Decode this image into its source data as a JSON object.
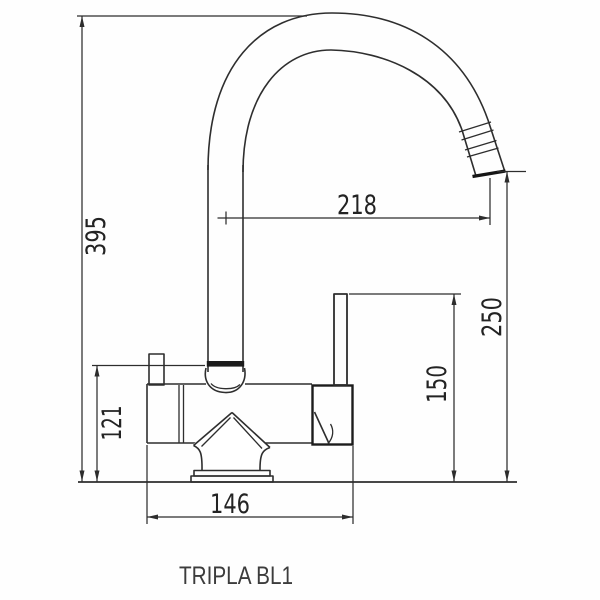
{
  "product": {
    "name": "TRIPLA BL1"
  },
  "dims": {
    "total_height": "395",
    "spout_reach": "218",
    "spout_outlet_height": "250",
    "handle_height": "150",
    "body_height": "121",
    "base_width": "146"
  },
  "drawing": {
    "type": "technical-dimension-drawing",
    "line_color": "#2e2e2e",
    "background": "#fefefe",
    "dimensions": [
      {
        "label": "395",
        "orientation": "vertical",
        "measures": "overall height to top of spout arc"
      },
      {
        "label": "218",
        "orientation": "horizontal",
        "measures": "spout reach from column axis to outlet"
      },
      {
        "label": "250",
        "orientation": "vertical",
        "measures": "outlet height above base"
      },
      {
        "label": "150",
        "orientation": "vertical",
        "measures": "handle lever height above base"
      },
      {
        "label": "121",
        "orientation": "vertical",
        "measures": "body joint height above base"
      },
      {
        "label": "146",
        "orientation": "horizontal",
        "measures": "body width"
      }
    ]
  }
}
